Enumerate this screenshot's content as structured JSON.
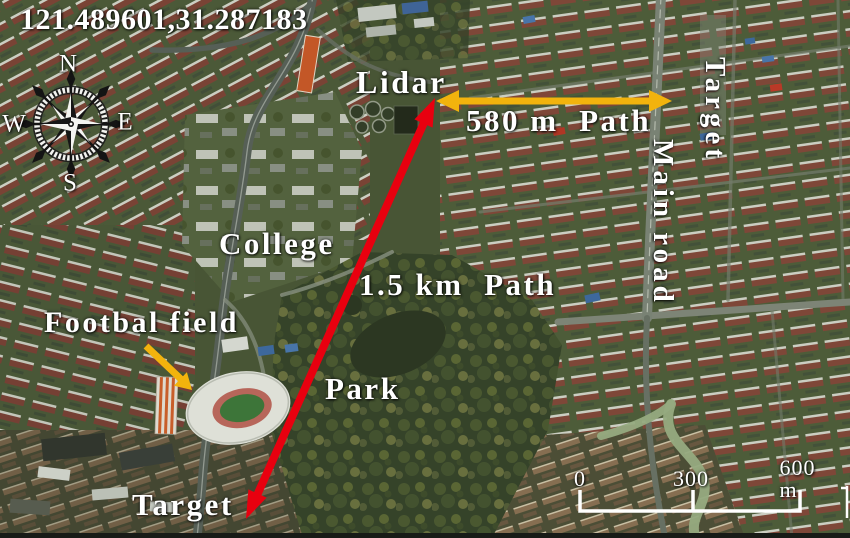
{
  "figure": {
    "coordinates": "121.489601,31.287183",
    "compass": {
      "north": "N",
      "east": "E",
      "south": "S",
      "west": "W"
    },
    "labels": {
      "lidar": "Lidar",
      "path_short": "580 m  Path",
      "target_east": "Target",
      "main_road": "Main road",
      "college": "College",
      "path_long": "1.5 km  Path",
      "football_field": "Footbal field",
      "park": "Park",
      "target_south": "Target"
    },
    "scale_bar": {
      "start": "0",
      "middle": "300",
      "end": "600 m"
    },
    "colors": {
      "path_arrow_yellow": "#f2b30d",
      "path_arrow_red": "#e8000f",
      "label_text": "#ffffff"
    }
  }
}
